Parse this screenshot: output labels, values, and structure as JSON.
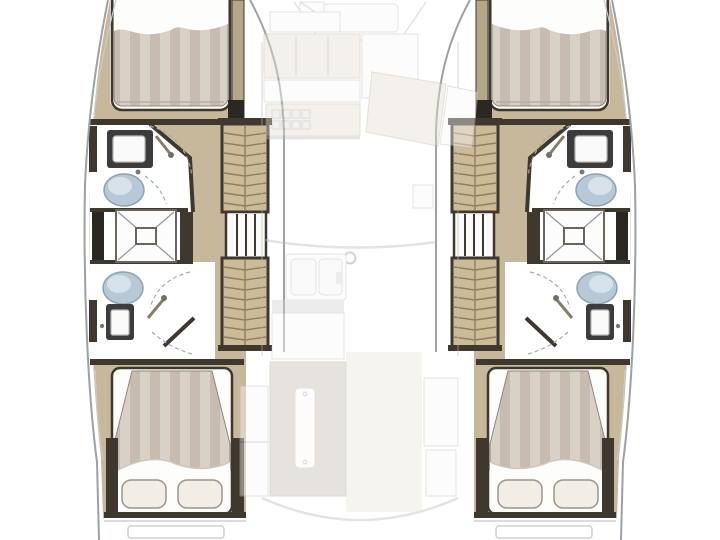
{
  "meta": {
    "kind": "boat floor plan",
    "view": "top-down interior deck plan of a catamaran, hull level shown solid, bridgedeck saloon shown faded",
    "visible_text": "none"
  },
  "colors": {
    "background": "#ffffff",
    "pure_white": "#ffffff",
    "hull_fill": "#ffffff",
    "hull_outline": "#9aa2a8",
    "hull_inner_line": "#c9ccce",
    "wood_floor": "#c8b89b",
    "wood_step": "#cdbb97",
    "wood_trim": "#b4a689",
    "tread_line": "#8d7f63",
    "wall_dark": "#3f382e",
    "wall_charcoal": "#2b2722",
    "mattress_stripe_light": "#d9d0c6",
    "mattress_stripe_dark": "#c8bcb0",
    "bedding_white": "#fdfdfc",
    "bed_shadow": "#b7aea2",
    "sheet_fold": "#cfc8bd",
    "pillow": "#f2ede5",
    "pillow_edge": "#9a938a",
    "toilet_blue": "#b7c9d6",
    "toilet_edge": "#8ba2b3",
    "toilet_highlight": "#d7e2ea",
    "fixture_dark": "#3c3c3c",
    "fixture_edge": "#b9b9b9",
    "fixture_white": "#fafafa",
    "tap": "#777777",
    "tray_fill": "#fcfcfc",
    "tray_edge": "#6b655c",
    "shower_line": "#9a9a9a",
    "dash_line": "#a8a8a8",
    "wand": "#8a7e68",
    "wand_head": "#6f6f6f",
    "stern_line": "#cfcfcf",
    "ghost_beige": "#e7e0d2",
    "ghost_beige_edge": "#bdb5a6",
    "ghost_gray": "#d2d2d2",
    "ghost_taupe": "#c4bdb1",
    "ghost_white": "#fafafa",
    "ghost_basin": "#f4f4f4",
    "ghost_line": "#bdbdbd",
    "ghost_floor": "#ece7de"
  },
  "vessel": {
    "type": "catamaran",
    "symmetry": "port and starboard hulls are mirror images",
    "port_hull_sections_bow_to_stern": [
      {
        "name": "forward-cabin",
        "features": [
          "double-berth",
          "striped-mattress",
          "white-bedding"
        ]
      },
      {
        "name": "forward-head",
        "features": [
          "washbasin",
          "toilet",
          "shower-with-handheld-head",
          "door-swing-arcs"
        ]
      },
      {
        "name": "midship-shower",
        "features": [
          "square-shower-tray-with-center-drain"
        ]
      },
      {
        "name": "aft-head",
        "features": [
          "toilet",
          "washbasin",
          "shower-with-handheld-head",
          "door-swing-arcs"
        ]
      },
      {
        "name": "companionway",
        "features": [
          "forward-steps",
          "slatted-landing",
          "aft-steps"
        ]
      },
      {
        "name": "aft-cabin",
        "features": [
          "double-berth",
          "striped-mattress",
          "two-pillows",
          "turned-down-sheet"
        ]
      },
      {
        "name": "transom",
        "features": [
          "swim-step-hatch"
        ]
      }
    ],
    "starboard_hull": {
      "mirror_of": "port_hull_sections_bow_to_stern"
    },
    "bridgedeck_ghosted_sections": [
      {
        "name": "forepeak",
        "features": [
          "anchor-locker",
          "bow-window-line"
        ]
      },
      {
        "name": "galley",
        "features": [
          "counters",
          "stove-grid",
          "double-sink",
          "cabinets"
        ]
      },
      {
        "name": "navigation-area",
        "features": [
          "angled-seat",
          "angled-table"
        ]
      },
      {
        "name": "saloon",
        "features": [
          "curved-settee",
          "mast-post"
        ]
      },
      {
        "name": "cockpit",
        "features": [
          "table-with-runner",
          "side-benches",
          "curved-transom-line"
        ]
      }
    ]
  }
}
